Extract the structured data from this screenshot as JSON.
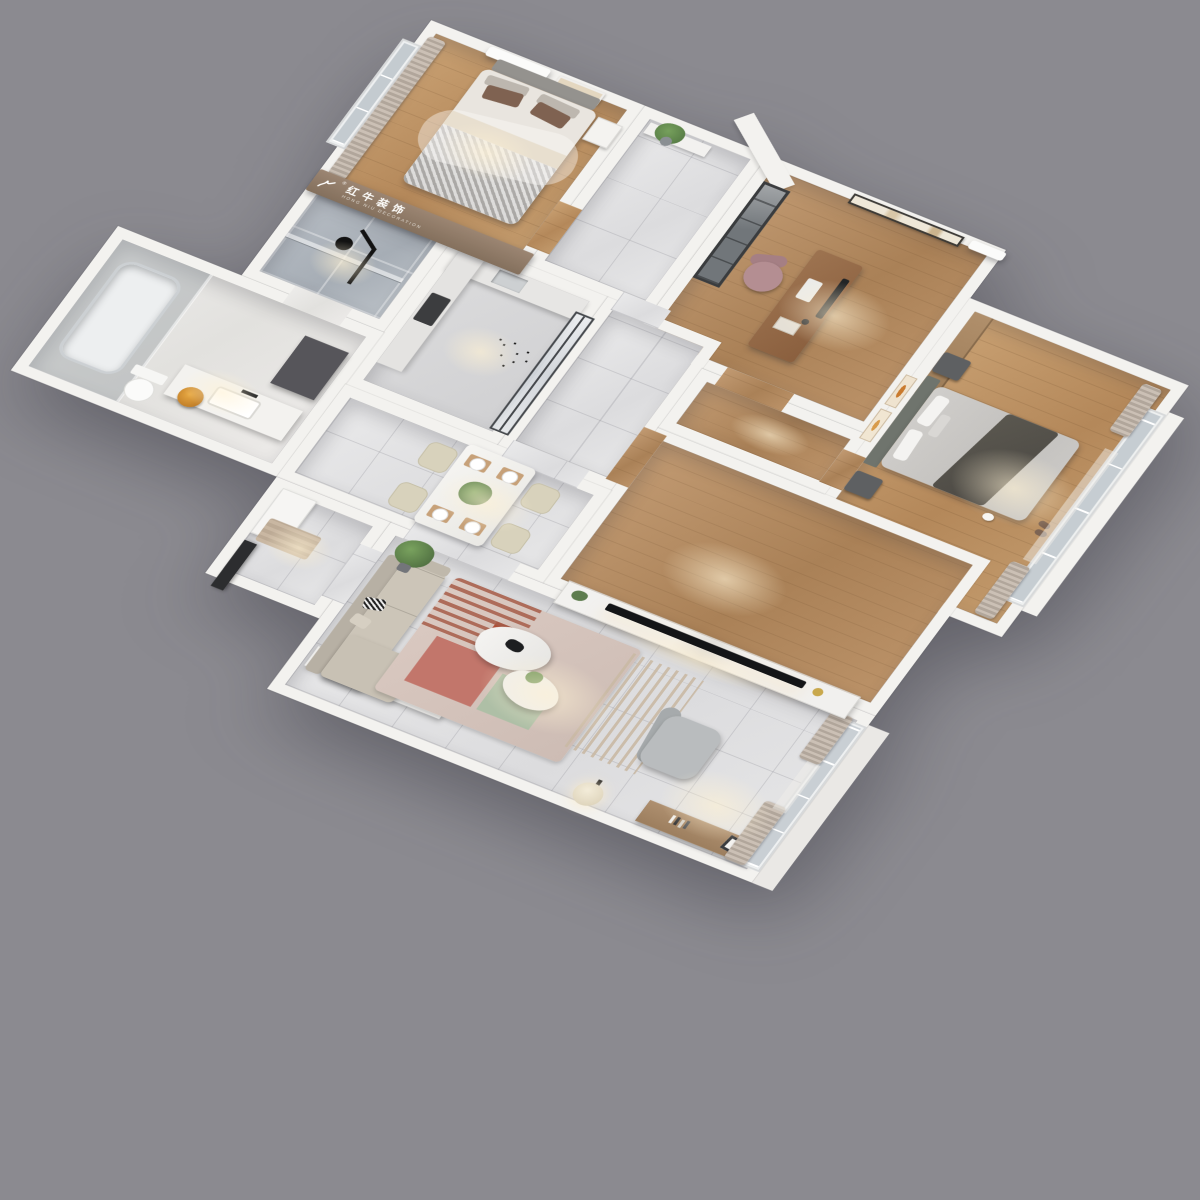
{
  "scene": {
    "description": "3D top-down render of a furnished apartment floor plan, rotated diagonally on a gray backdrop",
    "background_color": "#8b8a90",
    "wall_color": "#f3f2ef"
  },
  "watermark": {
    "brand_cn": "红牛装饰",
    "brand_en": "HONG NIU DECORATION",
    "registered_mark": "®"
  },
  "palette": {
    "wood_floor": "#c0986e",
    "tile_floor": "#e6e6e7",
    "bath_marble": "#eceae8",
    "frosted_glass": "#c6cdd2",
    "curtain": "#b7aca1",
    "sofa_beige": "#ccc5b8",
    "rug_terracotta": "#a65c48",
    "tv_black": "#141517",
    "banner_wood": "#8f7a66",
    "accent_orange": "#d88f2e",
    "plant_green": "#5d7c4e",
    "headboard_gray_green": "#6f746d"
  },
  "rooms": [
    {
      "id": "second-bedroom",
      "furniture": [
        "double-bed",
        "headboard",
        "pillows",
        "quilt",
        "sheer-throw",
        "nightstand",
        "window",
        "curtain",
        "air-conditioner",
        "wall-art",
        "brand-banner"
      ]
    },
    {
      "id": "hallway-niche",
      "furniture": [
        "shelf",
        "plant"
      ]
    },
    {
      "id": "study",
      "furniture": [
        "desk",
        "monitor",
        "keyboard",
        "office-chair",
        "bookcase",
        "wall-art",
        "air-conditioner"
      ]
    },
    {
      "id": "master-bedroom",
      "furniture": [
        "double-bed",
        "headboard",
        "throw-blanket",
        "rug",
        "slippers",
        "pet-cat",
        "nightstand-left",
        "nightstand-right",
        "wardrobe",
        "wall-art-frames",
        "bay-window",
        "curtains"
      ]
    },
    {
      "id": "shower-room",
      "furniture": [
        "rain-shower",
        "glass-screen"
      ]
    },
    {
      "id": "bathroom",
      "furniture": [
        "bathtub",
        "glass-partition",
        "vanity-counter",
        "sink",
        "faucet",
        "fruit-bowl",
        "cabinet",
        "toilet"
      ]
    },
    {
      "id": "kitchen",
      "furniture": [
        "counter",
        "cooktop",
        "sink",
        "glass-sliding-doors",
        "butterfly-decals"
      ]
    },
    {
      "id": "entry-hall",
      "furniture": [
        "shoe-cabinet",
        "doormat",
        "front-door"
      ]
    },
    {
      "id": "dining-area",
      "furniture": [
        "dining-table",
        "dining-chairs",
        "placemats",
        "plates",
        "centerpiece-plant"
      ]
    },
    {
      "id": "corridor",
      "furniture": []
    },
    {
      "id": "inner-hall",
      "furniture": [
        "tv-media-wall",
        "television",
        "decor-vase",
        "slat-screen"
      ]
    },
    {
      "id": "living-room",
      "furniture": [
        "l-shaped-sofa",
        "throw-pillows",
        "console-table",
        "copper-tray",
        "area-rug",
        "coffee-tables",
        "recliner",
        "floor-lamp",
        "sideboard",
        "leaning-frame",
        "tall-plant",
        "window-wall",
        "curtains"
      ]
    }
  ]
}
